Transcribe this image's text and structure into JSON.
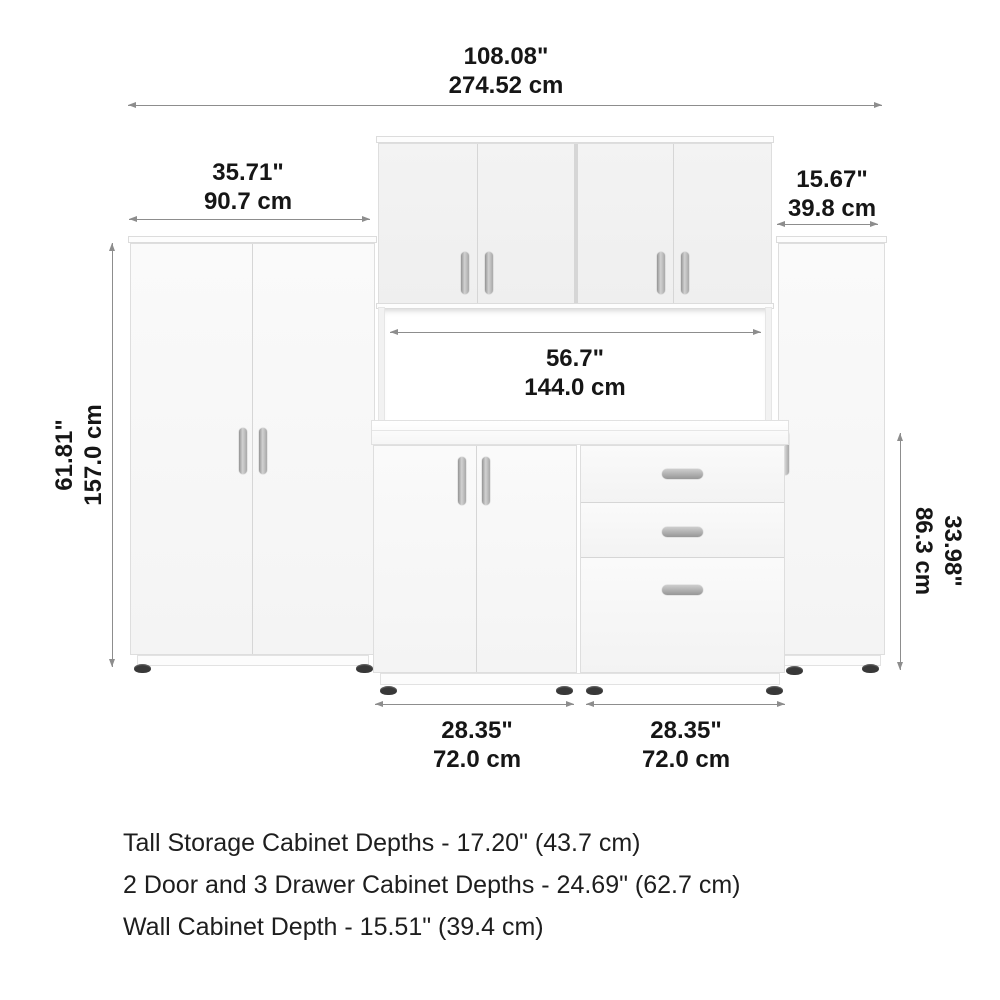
{
  "colors": {
    "background": "#ffffff",
    "cabinet_face": "#f7f7f7",
    "panel_seam": "#d6d6d6",
    "handle_metal": "#a8a8a8",
    "dimension_line": "#8d8d8d",
    "text": "#161616",
    "foot": "#383838"
  },
  "dims": {
    "overall_width": {
      "in": "108.08\"",
      "cm": "274.52 cm"
    },
    "tall_cab_width": {
      "in": "35.71\"",
      "cm": "90.7 cm"
    },
    "right_cab_width": {
      "in": "15.67\"",
      "cm": "39.8 cm"
    },
    "opening_width": {
      "in": "56.7\"",
      "cm": "144.0 cm"
    },
    "tall_cab_height": {
      "in": "61.81\"",
      "cm": "157.0 cm"
    },
    "base_cab_height": {
      "in": "33.98\"",
      "cm": "86.3 cm"
    },
    "base_left_width": {
      "in": "28.35\"",
      "cm": "72.0 cm"
    },
    "base_right_width": {
      "in": "28.35\"",
      "cm": "72.0 cm"
    }
  },
  "notes": [
    "Tall Storage Cabinet Depths - 17.20\" (43.7 cm)",
    "2 Door and 3 Drawer Cabinet Depths - 24.69\" (62.7 cm)",
    "Wall Cabinet Depth - 15.51\" (39.4 cm)"
  ]
}
